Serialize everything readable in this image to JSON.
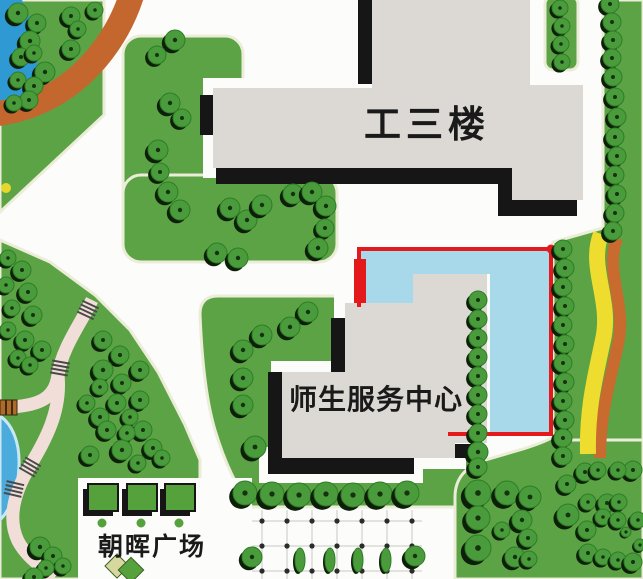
{
  "map": {
    "type": "campus-map",
    "buildings": [
      {
        "id": "gongsanlou",
        "label": "工三楼"
      },
      {
        "id": "shisheng-service-center",
        "label": "师生服务中心"
      }
    ],
    "plaza_label": "朝晖广场",
    "annotation": {
      "kind": "highlight-rectangle",
      "stroke": "#e3191b",
      "fill": "#a8d9ea",
      "corner_dot": [
        551,
        249
      ],
      "entrance_marker": {
        "x": 354,
        "y": 259,
        "w": 12,
        "h": 44
      }
    },
    "colors": {
      "road_white": "#fcfcfa",
      "green_base": "#5ba345",
      "green_edge": "#ecedd9",
      "tree_green": "#4a9b3b",
      "tree_ring": "#2e7d26",
      "tree_dot": "#14330e",
      "tree_shadow": "#0d1f08",
      "building_gray": "#dcd9d4",
      "building_black": "#161616",
      "highlight_fill": "#a8d9ea",
      "highlight_stroke": "#e3191b",
      "pond_blue": "#2f99d3",
      "pond_blue2": "#4aabdc",
      "pond_rim": "#c9e8f4",
      "path_orange": "#c4672f",
      "path_pink": "#f2ded8",
      "tie_dark": "#4a4a4a",
      "bridge_brown": "#b06a28",
      "ribbon_yellow": "#eedd2e",
      "ribbon_orange": "#c96b2f",
      "plaza_square_green": "#55a23d",
      "grid_line": "#d9d9d4",
      "grid_dot": "#2b2b2b",
      "label_black": "#1a1a1a",
      "diamond_khaki": "#d6d89e",
      "yellow_dot": "#e6d82a"
    },
    "plaza_grid": {
      "cols": [
        262,
        287,
        312,
        337,
        362,
        387,
        412
      ],
      "rows": [
        521,
        546,
        571
      ],
      "y_top": 510,
      "y_bottom": 579,
      "bushes_x": [
        300,
        330,
        358,
        386
      ],
      "bush_y": 560
    },
    "plaza_squares": {
      "xs": [
        88,
        127,
        165
      ],
      "y": 484,
      "w": 30,
      "h": 27,
      "dots": [
        [
          102,
          523
        ],
        [
          141,
          523
        ],
        [
          179,
          523
        ]
      ]
    },
    "diamonds": [
      {
        "cx": 117,
        "cy": 566,
        "s": 17,
        "color": "khaki"
      },
      {
        "cx": 131,
        "cy": 570,
        "s": 18,
        "color": "green"
      }
    ],
    "trees": [
      [
        18,
        13,
        10
      ],
      [
        37,
        23,
        9
      ],
      [
        30,
        41,
        10
      ],
      [
        21,
        57,
        9
      ],
      [
        34,
        53,
        8
      ],
      [
        45,
        72,
        10
      ],
      [
        18,
        80,
        8
      ],
      [
        34,
        86,
        9
      ],
      [
        29,
        100,
        9
      ],
      [
        14,
        103,
        8
      ],
      [
        71,
        16,
        9
      ],
      [
        78,
        29,
        8
      ],
      [
        71,
        49,
        9
      ],
      [
        95,
        10,
        8
      ],
      [
        175,
        40,
        10
      ],
      [
        157,
        55,
        9
      ],
      [
        170,
        103,
        10
      ],
      [
        182,
        118,
        9
      ],
      [
        158,
        150,
        10
      ],
      [
        160,
        172,
        9
      ],
      [
        168,
        192,
        10
      ],
      [
        180,
        210,
        10
      ],
      [
        230,
        208,
        10
      ],
      [
        247,
        220,
        10
      ],
      [
        262,
        205,
        10
      ],
      [
        217,
        253,
        10
      ],
      [
        238,
        258,
        10
      ],
      [
        293,
        194,
        10
      ],
      [
        312,
        192,
        10
      ],
      [
        326,
        206,
        10
      ],
      [
        325,
        228,
        9
      ],
      [
        318,
        248,
        10
      ],
      [
        8,
        258,
        8
      ],
      [
        22,
        270,
        9
      ],
      [
        6,
        285,
        8
      ],
      [
        28,
        292,
        9
      ],
      [
        12,
        308,
        8
      ],
      [
        33,
        315,
        9
      ],
      [
        8,
        330,
        8
      ],
      [
        25,
        340,
        9
      ],
      [
        18,
        358,
        8
      ],
      [
        42,
        350,
        9
      ],
      [
        30,
        365,
        8
      ],
      [
        103,
        340,
        9
      ],
      [
        120,
        355,
        9
      ],
      [
        103,
        370,
        10
      ],
      [
        122,
        383,
        9
      ],
      [
        140,
        370,
        9
      ],
      [
        100,
        387,
        8
      ],
      [
        117,
        403,
        9
      ],
      [
        140,
        400,
        9
      ],
      [
        130,
        417,
        8
      ],
      [
        100,
        417,
        9
      ],
      [
        87,
        403,
        8
      ],
      [
        143,
        430,
        9
      ],
      [
        127,
        433,
        8
      ],
      [
        107,
        430,
        9
      ],
      [
        90,
        455,
        9
      ],
      [
        122,
        450,
        10
      ],
      [
        153,
        448,
        9
      ],
      [
        162,
        458,
        8
      ],
      [
        138,
        463,
        8
      ],
      [
        40,
        547,
        10
      ],
      [
        53,
        556,
        9
      ],
      [
        63,
        566,
        8
      ],
      [
        46,
        568,
        8
      ],
      [
        34,
        577,
        9
      ],
      [
        308,
        312,
        10
      ],
      [
        290,
        327,
        10
      ],
      [
        262,
        335,
        10
      ],
      [
        243,
        350,
        10
      ],
      [
        243,
        378,
        10
      ],
      [
        243,
        405,
        10
      ],
      [
        255,
        447,
        11
      ],
      [
        245,
        493,
        12
      ],
      [
        272,
        494,
        12
      ],
      [
        299,
        495,
        12
      ],
      [
        326,
        494,
        12
      ],
      [
        353,
        495,
        12
      ],
      [
        380,
        494,
        12
      ],
      [
        407,
        493,
        12
      ],
      [
        478,
        300,
        9
      ],
      [
        478,
        319,
        9
      ],
      [
        478,
        338,
        9
      ],
      [
        478,
        357,
        9
      ],
      [
        478,
        376,
        9
      ],
      [
        478,
        395,
        9
      ],
      [
        478,
        414,
        9
      ],
      [
        478,
        433,
        9
      ],
      [
        478,
        452,
        10
      ],
      [
        478,
        467,
        9
      ],
      [
        560,
        8,
        8
      ],
      [
        562,
        26,
        8
      ],
      [
        561,
        44,
        8
      ],
      [
        562,
        62,
        8
      ],
      [
        610,
        4,
        9
      ],
      [
        612,
        22,
        9
      ],
      [
        613,
        40,
        9
      ],
      [
        612,
        58,
        9
      ],
      [
        613,
        77,
        9
      ],
      [
        615,
        97,
        9
      ],
      [
        617,
        117,
        9
      ],
      [
        615,
        137,
        9
      ],
      [
        617,
        156,
        9
      ],
      [
        615,
        175,
        9
      ],
      [
        617,
        194,
        9
      ],
      [
        615,
        213,
        9
      ],
      [
        613,
        231,
        9
      ],
      [
        563,
        249,
        9
      ],
      [
        565,
        268,
        9
      ],
      [
        563,
        287,
        9
      ],
      [
        565,
        306,
        9
      ],
      [
        563,
        325,
        9
      ],
      [
        565,
        344,
        9
      ],
      [
        563,
        363,
        9
      ],
      [
        565,
        382,
        9
      ],
      [
        563,
        401,
        9
      ],
      [
        565,
        420,
        9
      ],
      [
        563,
        438,
        9
      ],
      [
        563,
        456,
        9
      ],
      [
        585,
        472,
        9
      ],
      [
        567,
        484,
        9
      ],
      [
        478,
        493,
        13
      ],
      [
        507,
        493,
        12
      ],
      [
        530,
        497,
        11
      ],
      [
        478,
        518,
        12
      ],
      [
        522,
        520,
        10
      ],
      [
        502,
        530,
        8
      ],
      [
        528,
        538,
        9
      ],
      [
        478,
        548,
        13
      ],
      [
        515,
        557,
        10
      ],
      [
        529,
        559,
        8
      ],
      [
        568,
        515,
        11
      ],
      [
        588,
        502,
        8
      ],
      [
        607,
        503,
        9
      ],
      [
        619,
        502,
        8
      ],
      [
        603,
        517,
        8
      ],
      [
        618,
        520,
        8
      ],
      [
        587,
        530,
        9
      ],
      [
        588,
        553,
        9
      ],
      [
        603,
        557,
        8
      ],
      [
        618,
        560,
        8
      ],
      [
        633,
        562,
        9
      ],
      [
        638,
        520,
        8
      ],
      [
        633,
        470,
        9
      ],
      [
        618,
        470,
        8
      ],
      [
        598,
        470,
        8
      ],
      [
        626,
        532,
        5
      ],
      [
        640,
        545,
        6
      ],
      [
        252,
        557,
        10
      ],
      [
        415,
        556,
        10
      ]
    ]
  }
}
